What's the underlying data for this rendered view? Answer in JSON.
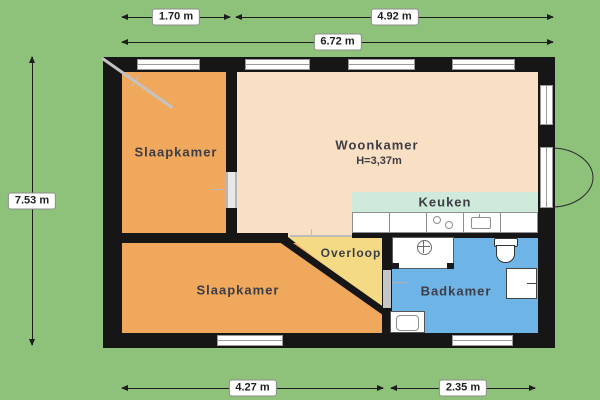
{
  "dimensions": {
    "top_row1": [
      {
        "label": "1.70 m"
      },
      {
        "label": "4.92 m"
      }
    ],
    "top_total": {
      "label": "6.72 m"
    },
    "left": {
      "label": "7.53 m"
    },
    "bottom": [
      {
        "label": "4.27 m"
      },
      {
        "label": "2.35 m"
      }
    ]
  },
  "rooms": {
    "slaapkamer_top": "Slaapkamer",
    "woonkamer": "Woonkamer",
    "woonkamer_height": "H=3,37m",
    "keuken": "Keuken",
    "overloop": "Overloop",
    "slaapkamer_bottom": "Slaapkamer",
    "badkamer": "Badkamer"
  },
  "colors": {
    "background": "#8ec27b",
    "wall": "#161616",
    "bedroom": "#f0a85d",
    "living": "#f9dfc4",
    "kitchen": "#cfe9da",
    "hallway": "#f4da85",
    "bathroom": "#6fb4e6",
    "label_text": "#3d3d46"
  }
}
